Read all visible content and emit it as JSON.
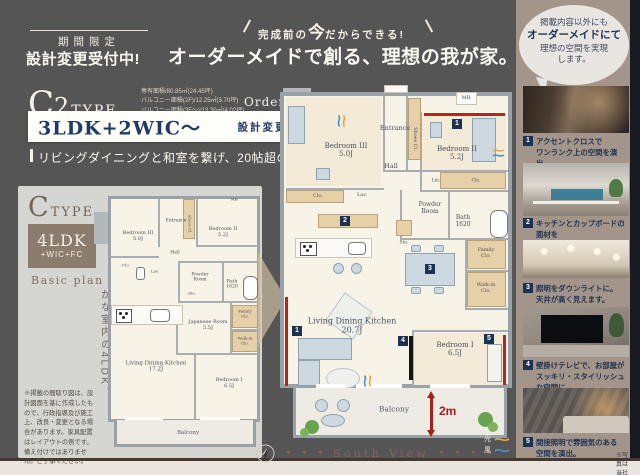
{
  "header": {
    "badge": "期間限定",
    "badge_sub": "設計変更受付中!",
    "catch_pre": "完成前の",
    "catch_big": "今",
    "catch_post": "だからできる!",
    "catch_main": "オーダーメイドで創る、理想の我が家。"
  },
  "bubble": {
    "line1": "掲載内容以外にも",
    "line2": "オーダーメイドにて",
    "line3": "理想の空間を実現",
    "line4": "します。"
  },
  "order_plan": {
    "type_letter": "C",
    "type_num": "2",
    "type_word": "TYPE",
    "area1": "専有面積/80.85㎡(24.45坪)",
    "area2": "バルコニー面積(2F)/12.25㎡(3.70坪)",
    "area3": "バルコニー面積(3F〜)/13.30㎡(4.02坪)",
    "plan_tag": "Order plan",
    "layout": "3LDK+2WIC〜",
    "example_tag": "設計変更例",
    "tagline": "リビングダイニングと和室を繋げ、20帖超の大空間に。",
    "balcony_depth": "2m",
    "markers": {
      "m1": "1",
      "m2": "2",
      "m3": "3",
      "m4": "4",
      "m5": "5"
    },
    "rooms": {
      "bedroom3": "Bedroom III",
      "bedroom3_size": "5.0J",
      "entrance": "Entrance",
      "shoes": "Shoes Cl.",
      "mb": "MB",
      "hall": "Hall",
      "bedroom2": "Bedroom II",
      "bedroom2_size": "5.2J",
      "clo": "Clo.",
      "lav": "Lav.",
      "lin": "Lin.",
      "powder_l1": "Powder",
      "powder_l2": "Room",
      "bath": "Bath",
      "bath_size": "1620",
      "sto": "Sto.",
      "family_l1": "Family",
      "family_l2": "Clo.",
      "walkin_l1": "Walk-in",
      "walkin_l2": "Clo.",
      "ldk": "Living Dining Kitchen",
      "ldk_size": "20.7J",
      "bedroom1": "Bedroom I",
      "bedroom1_size": "6.5J",
      "balcony": "Balcony"
    }
  },
  "basic_plan": {
    "type_letter": "C",
    "type_word": "TYPE",
    "layout_main": "4LDK",
    "layout_sub": "+WIC+FC",
    "plan_tag": "Basic plan",
    "tagline_col1": "3面採光で、明るく",
    "tagline_col2": "爽やかな室内の4LDK。",
    "disclaimer": "※掲載の間取り図は、設計図面を基に作成したもので、行政指導及び施工上、改良・変更となる場合があります。家具配置はレイアウトの例です。備え付けではありません。ご了承ください。",
    "rooms": {
      "bedroom3": "Bedroom III",
      "bedroom3_size": "5.0J",
      "entrance": "Entrance",
      "shoes": "Shoes Cl.",
      "mb": "MB",
      "hall": "Hall",
      "bedroom2": "Bedroom II",
      "bedroom2_size": "5.2J",
      "clo": "Clo.",
      "lav": "Lav.",
      "powder_l1": "Powder",
      "powder_l2": "Room",
      "bath": "Bath",
      "bath_size": "1620",
      "sto": "Sto.",
      "family_l1": "Family",
      "family_l2": "Clo.",
      "japanese": "Japanese Room",
      "japanese_size": "5.5J",
      "walkin_l1": "Walk-in",
      "walkin_l2": "Clo.",
      "ldk": "Living Dining Kitchen",
      "ldk_size": "17.2J",
      "bedroom1": "Bedroom I",
      "bedroom1_size": "6.5J",
      "balcony": "Balcony"
    }
  },
  "footer": {
    "south_view": "South View",
    "arrow": "▼",
    "light": "光",
    "wind": "風",
    "photo_note": "※写真は当社施工例"
  },
  "photos": [
    {
      "num": "1",
      "line1": "アクセントクロスで",
      "line2": "ワンランク上の空間を演出。"
    },
    {
      "num": "2",
      "line1": "キッチンとカップボードの面材を",
      "line2": "合わせ、統一感のある空間に。"
    },
    {
      "num": "3",
      "line1": "照明をダウンライトに。",
      "line2": "天井が高く見えます。"
    },
    {
      "num": "4",
      "line1": "壁掛けテレビで、お部屋が",
      "line2": "スッキリ・スタイリッシュな空間に。"
    },
    {
      "num": "5",
      "line1": "間接照明で雰囲気のある",
      "line2": "空間を演出。"
    }
  ]
}
